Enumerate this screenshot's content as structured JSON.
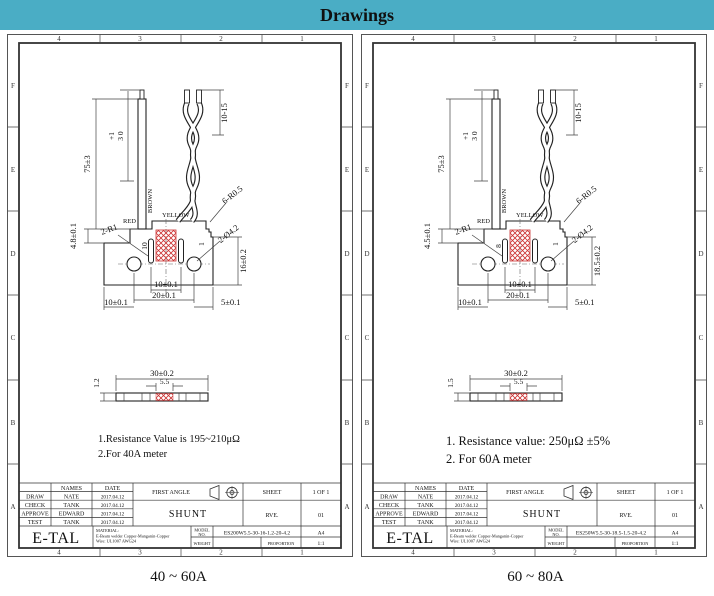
{
  "header": {
    "title": "Drawings"
  },
  "colors": {
    "header_bg": "#4aadc5",
    "hatch_red": "#cc3333",
    "line": "#333333",
    "background": "#ffffff"
  },
  "captions": {
    "left": "40 ~ 60A",
    "right": "60 ~ 80A"
  },
  "frame": {
    "cols": [
      "4",
      "3",
      "2",
      "1"
    ],
    "rows": [
      "F",
      "E",
      "D",
      "C",
      "B",
      "A"
    ]
  },
  "shared": {
    "dims": {
      "total_height": "75±3",
      "strip_tol": "+1",
      "strip_len": "3 0",
      "wire_free": "10-15",
      "wire_red": "RED",
      "wire_brown": "BROWN",
      "wire_yellow": "YELLOW",
      "fillets": "6-R0.5",
      "corners": "2-R1",
      "notch": "1",
      "holes": "2-Ø4.2",
      "slot_pitch": "10±0.1",
      "hole_pitch": "20±0.1",
      "left_margin": "10±0.1",
      "right_margin": "5±0.1",
      "length": "30±0.2",
      "weld_width": "5.5"
    },
    "tb": {
      "names": "NAMES",
      "date": "DATE",
      "draw": "DRAW",
      "draw_name": "NATE",
      "check": "CHECK",
      "check_name": "TANK",
      "approve": "APPROVE",
      "approve_name": "EDWARD",
      "test": "TEST",
      "test_name": "TANK",
      "date_value": "2017.04.12",
      "first_angle": "FIRST ANGLE",
      "sheet": "SHEET",
      "sheet_value": "1 OF 1",
      "part": "SHUNT",
      "rev": "RVE.",
      "rev_value": "01",
      "logo": "E-TAL",
      "material_label": "MATERIAL:",
      "material_line1": "E-Beam welder Copper-Manganin-Copper",
      "material_line2": "Wire: UL1007 AWG24",
      "model_label1": "MODEL",
      "model_label2": "NO.",
      "paper": "A4",
      "weight": "WEIGHT",
      "proportion": "PROPORTION",
      "proportion_value": "1:1"
    }
  },
  "left": {
    "step_height": "4.8±0.1",
    "slot_depth": "10",
    "body_height": "16±0.2",
    "thickness": "1.2",
    "note1": "1.Resistance Value is 195~210μΩ",
    "note2": "2.For 40A meter",
    "model_value": "ES200W5.5-30-16-1.2-20-4.2"
  },
  "right": {
    "step_height": "4.5±0.1",
    "slot_depth": "8",
    "body_height": "18.5±0.2",
    "thickness": "1.5",
    "note1": "1. Resistance value: 250μΩ ±5%",
    "note2": "2. For 60A meter",
    "model_value": "ES250W5.5-30-18.5-1.5-20-4.2"
  }
}
